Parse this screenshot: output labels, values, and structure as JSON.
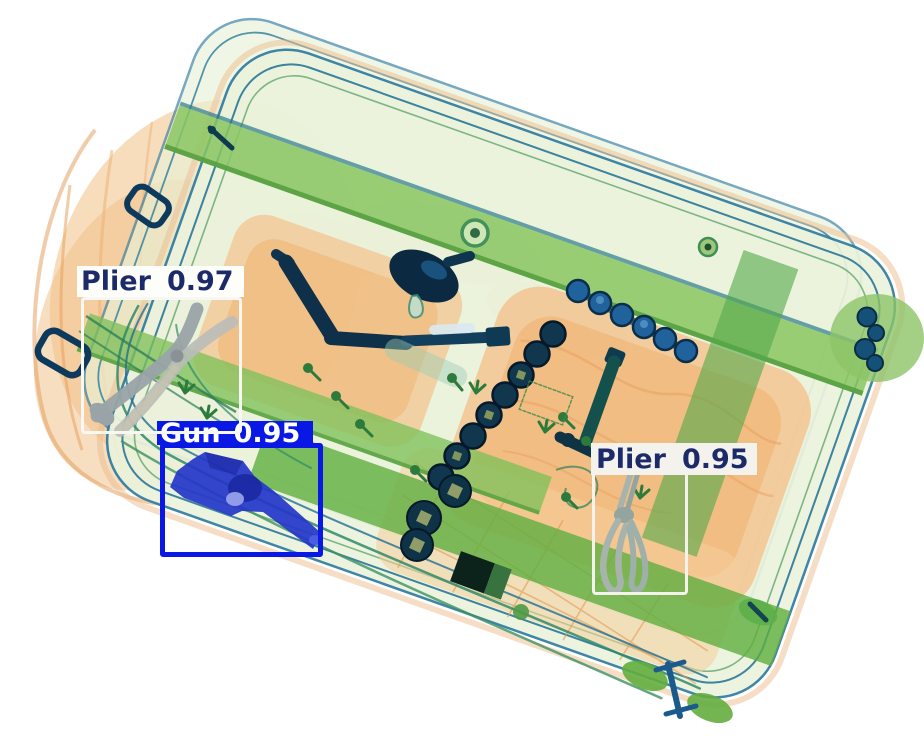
{
  "image": {
    "kind": "x-ray baggage security scan with object detection overlay",
    "background_color": "#ffffff",
    "objects_visible": [
      "suitcase",
      "soft-bag",
      "gun",
      "plier-left",
      "plier-right",
      "ratchet-crank-tool",
      "socket-chain",
      "socket-rings",
      "breaker-bar",
      "straps",
      "cords"
    ],
    "palette": {
      "case_fill": "#ebf3dc",
      "case_outline": "#2e7ba0",
      "strap_green": "#5fae3f",
      "fabric_orange": "#f4c28c",
      "tool_navy": "#0f3049",
      "socket_blue": "#20639c",
      "plier_grey": "#9aa3a8",
      "gun_blue": "#2336c8"
    }
  },
  "detections": [
    {
      "class": "Plier",
      "score": "0.97",
      "box_color": "#f7f7f3",
      "label_bg": "#fdfdfa",
      "text_color": "#1c2a6a"
    },
    {
      "class": "Gun",
      "score": "0.95",
      "box_color": "#0a18e6",
      "label_bg": "#0a18e6",
      "text_color": "#ffffff"
    },
    {
      "class": "Plier",
      "score": "0.95",
      "box_color": "#f3f2ec",
      "label_bg": "#f3f2ec",
      "text_color": "#1c2a6a"
    }
  ]
}
